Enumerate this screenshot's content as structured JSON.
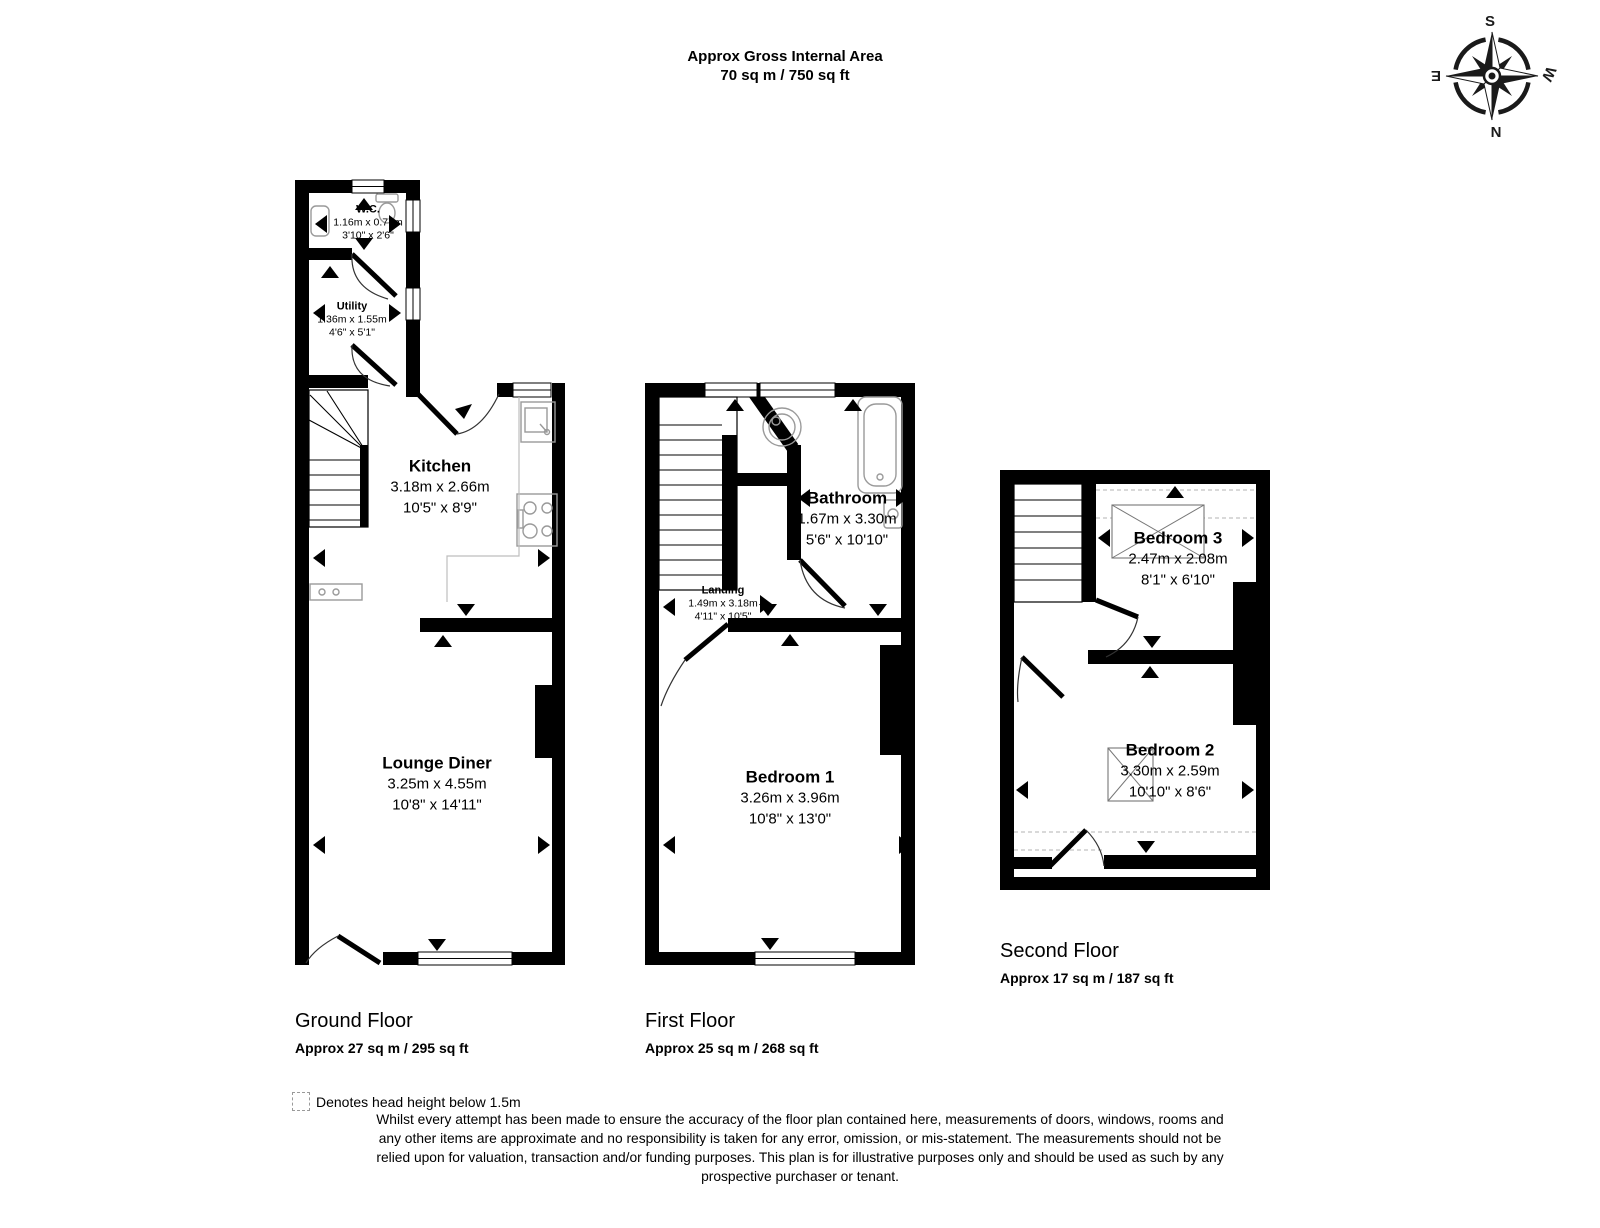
{
  "header": {
    "title_line1": "Approx Gross Internal Area",
    "title_line2": "70 sq m / 750 sq ft"
  },
  "compass": {
    "n": "N",
    "s": "S",
    "e": "E",
    "w": "W"
  },
  "floors": [
    {
      "title": "Ground Floor",
      "area": "Approx 27 sq m / 295 sq ft",
      "rooms": [
        {
          "name": "W.C.",
          "metric": "1.16m x 0.77m",
          "imperial": "3'10\" x 2'6\""
        },
        {
          "name": "Utility",
          "metric": "1.36m x 1.55m",
          "imperial": "4'6\" x 5'1\""
        },
        {
          "name": "Kitchen",
          "metric": "3.18m x 2.66m",
          "imperial": "10'5\" x 8'9\""
        },
        {
          "name": "Lounge Diner",
          "metric": "3.25m x 4.55m",
          "imperial": "10'8\" x 14'11\""
        }
      ]
    },
    {
      "title": "First Floor",
      "area": "Approx 25 sq m / 268 sq ft",
      "rooms": [
        {
          "name": "Bathroom",
          "metric": "1.67m x 3.30m",
          "imperial": "5'6\" x 10'10\""
        },
        {
          "name": "Landing",
          "metric": "1.49m x 3.18m",
          "imperial": "4'11\" x 10'5\""
        },
        {
          "name": "Bedroom 1",
          "metric": "3.26m x 3.96m",
          "imperial": "10'8\" x 13'0\""
        }
      ]
    },
    {
      "title": "Second Floor",
      "area": "Approx 17 sq m / 187 sq ft",
      "rooms": [
        {
          "name": "Bedroom 3",
          "metric": "2.47m x 2.08m",
          "imperial": "8'1\" x 6'10\""
        },
        {
          "name": "Bedroom 2",
          "metric": "3.30m x 2.59m",
          "imperial": "10'10\" x 8'6\""
        }
      ]
    }
  ],
  "legend": {
    "head_height": "Denotes head height below 1.5m",
    "disclaimer_lines": [
      "Whilst every attempt has been made to ensure the accuracy of the floor plan contained here, measurements of doors, windows, rooms and",
      "any other items are approximate and no responsibility is taken for any error, omission, or mis-statement. The measurements should not be",
      "relied upon for valuation, transaction and/or funding purposes. This plan is for illustrative purposes only and should be used as such by any",
      "prospective purchaser or tenant."
    ]
  },
  "colors": {
    "wall": "#000000",
    "fixture": "#9a9a9a",
    "dashed_line": "#b3b3b3",
    "background": "#ffffff"
  }
}
